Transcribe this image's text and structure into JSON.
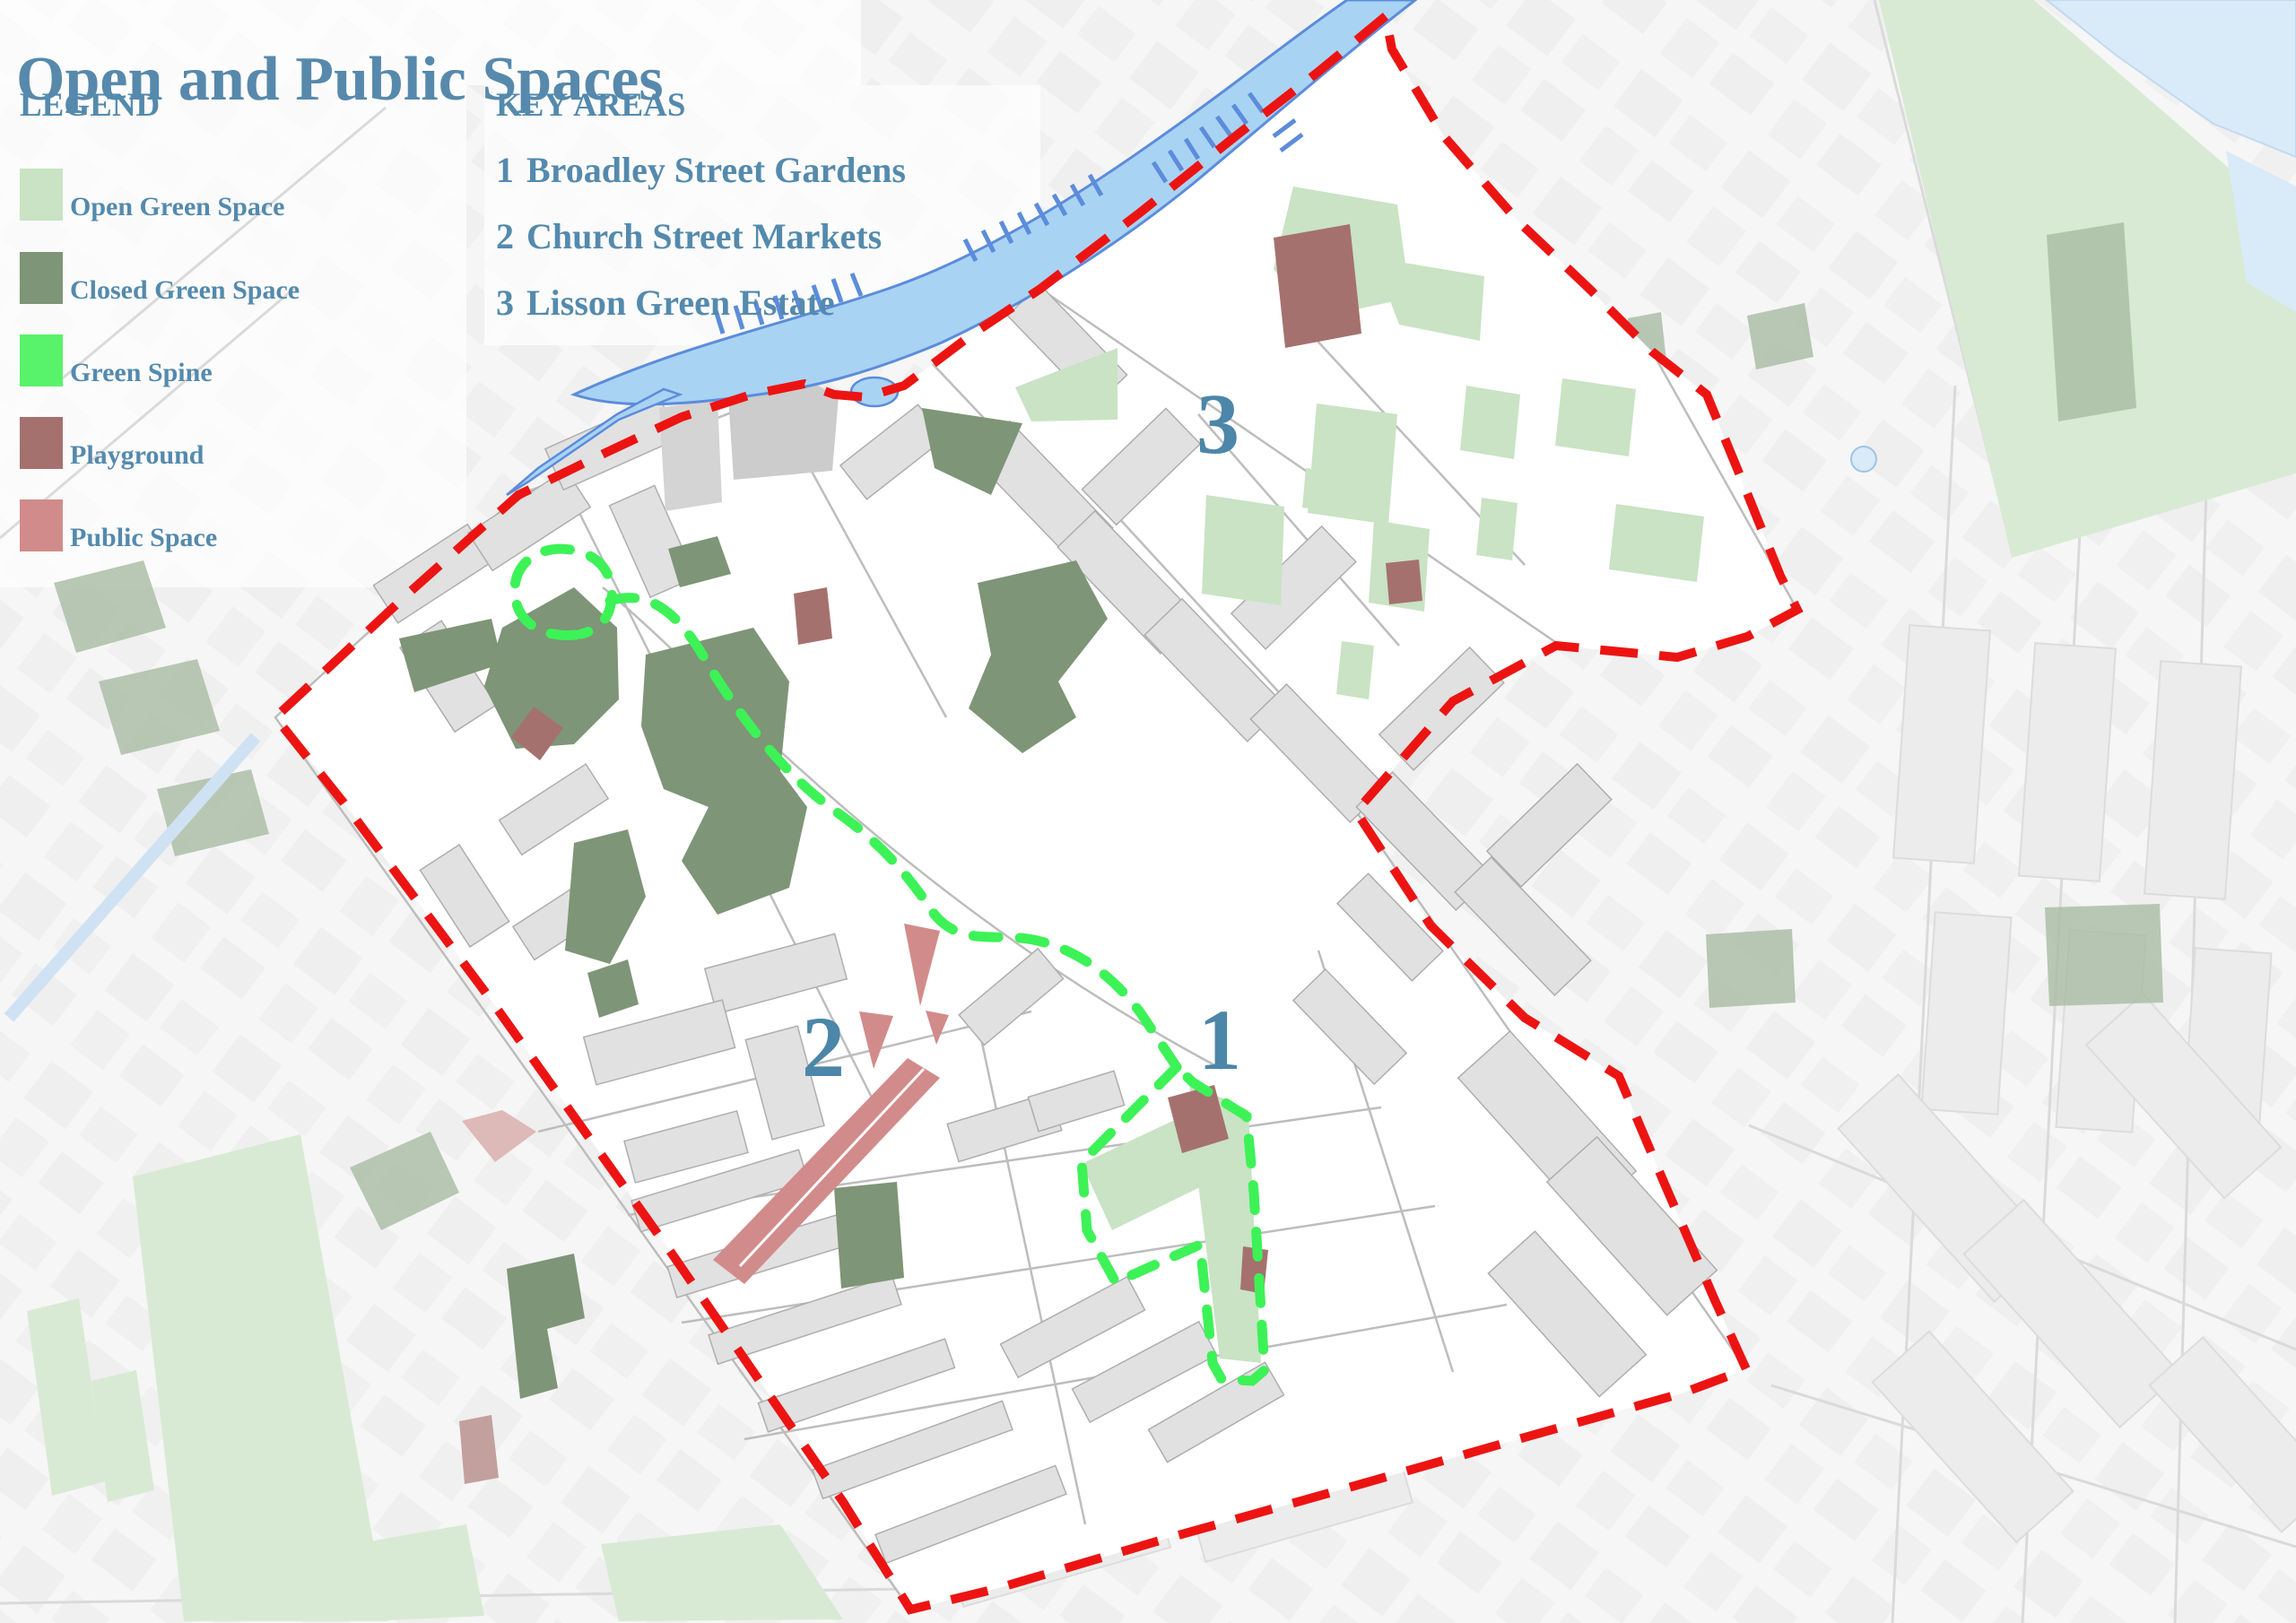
{
  "title": "Open and Public Spaces",
  "legend": {
    "heading": "LEGEND",
    "items": [
      {
        "label": "Open Green Space",
        "color": "#c9e3c4"
      },
      {
        "label": "Closed Green Space",
        "color": "#7e9577"
      },
      {
        "label": "Green Spine",
        "color": "#59f26b"
      },
      {
        "label": "Playground",
        "color": "#a5716e"
      },
      {
        "label": "Public Space",
        "color": "#d28b8b"
      }
    ]
  },
  "key_areas": {
    "heading": "KEY AREAS",
    "items": [
      {
        "number": "1",
        "name": "Broadley Street Gardens"
      },
      {
        "number": "2",
        "name": "Church Street Markets"
      },
      {
        "number": "3",
        "name": "Lisson Green Estate"
      }
    ]
  },
  "map": {
    "markers": [
      {
        "id": "1",
        "label": "1"
      },
      {
        "id": "2",
        "label": "2"
      },
      {
        "id": "3",
        "label": "3"
      }
    ],
    "colors": {
      "boundary_red": "#ec1412",
      "spine_green": "#3df257",
      "open_green": "#c9e3c4",
      "closed_green": "#7e9577",
      "playground": "#a5716e",
      "public_space": "#d28b8b",
      "canal_fill": "#a9d3f3",
      "canal_stroke": "#5c8cdb",
      "label_blue": "#4c86a8"
    }
  }
}
